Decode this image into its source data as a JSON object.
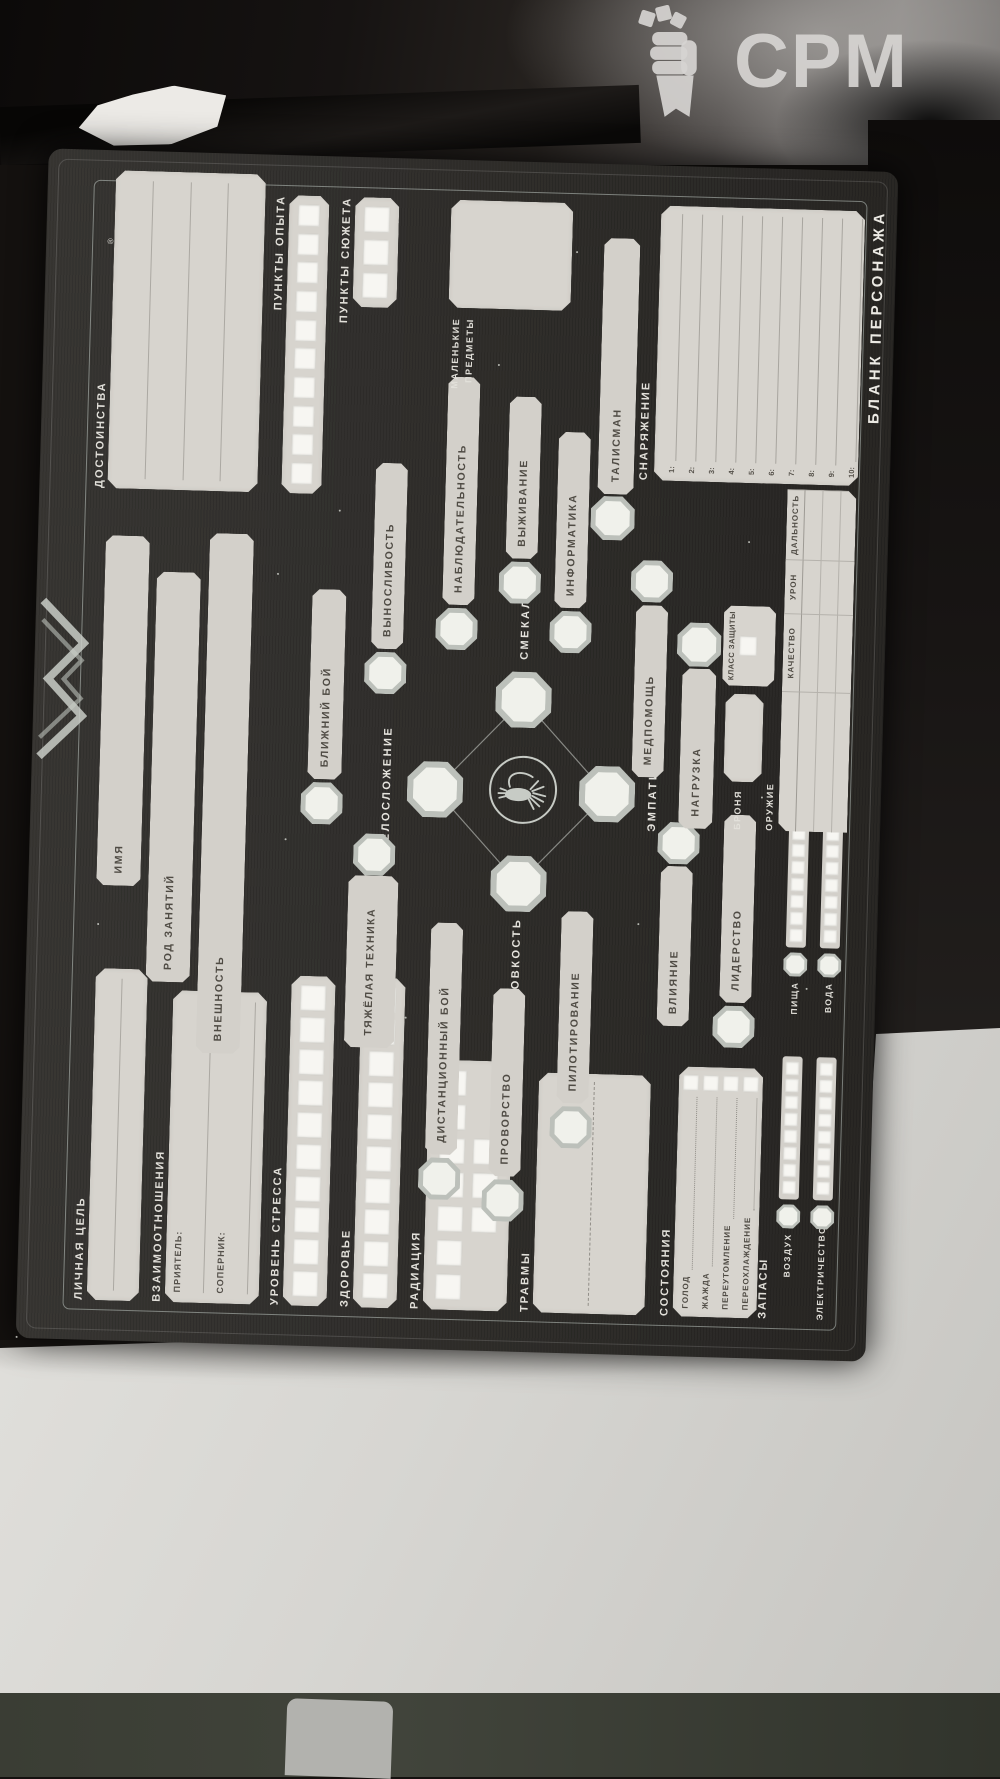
{
  "watermark": {
    "brand": "CPM"
  },
  "sheet": {
    "title": "БЛАНК ПЕРСОНАЖА",
    "reg_mark": "®",
    "identity": {
      "name_label": "ИМЯ",
      "career_label": "РОД ЗАНЯТИЙ",
      "appearance_label": "ВНЕШНОСТЬ"
    },
    "left": {
      "personal_goal": "ЛИЧНАЯ ЦЕЛЬ",
      "relationships": "ВЗАИМООТНОШЕНИЯ",
      "buddy": "ПРИЯТЕЛЬ:",
      "rival": "СОПЕРНИК:",
      "stress": "УРОВЕНЬ СТРЕССА",
      "health": "ЗДОРОВЬЕ",
      "radiation": "РАДИАЦИЯ",
      "injuries": "ТРАВМЫ",
      "conditions": {
        "title": "СОСТОЯНИЯ",
        "items": [
          "ГОЛОД",
          "ЖАЖДА",
          "ПЕРЕУТОМЛЕНИЕ",
          "ПЕРЕОХЛАЖДЕНИЕ"
        ]
      },
      "supplies": {
        "title": "ЗАПАСЫ",
        "items": [
          "ВОЗДУХ",
          "ПИЩА",
          "ЭЛЕКТРИЧЕСТВО",
          "ВОДА"
        ]
      }
    },
    "attributes": [
      "ТЕЛОСЛОЖЕНИЕ",
      "ЛОВКОСТЬ",
      "СМЕКАЛКА",
      "ЭМПАТИЯ"
    ],
    "skills": {
      "strength": [
        "БЛИЖНИЙ БОЙ",
        "ТЯЖЁЛАЯ ТЕХНИКА",
        "ВЫНОСЛИВОСТЬ"
      ],
      "agility": [
        "ДИСТАНЦИОННЫЙ БОЙ",
        "ПРОВОРСТВО",
        "ПИЛОТИРОВАНИЕ"
      ],
      "wits": [
        "НАБЛЮДАТЕЛЬНОСТЬ",
        "ВЫЖИВАНИЕ",
        "ИНФОРМАТИКА"
      ],
      "empathy": [
        "МЕДПОМОЩЬ",
        "ВЛИЯНИЕ",
        "ЛИДЕРСТВО"
      ]
    },
    "right": {
      "talents": "ДОСТОИНСТВА",
      "xp": "ПУНКТЫ ОПЫТА",
      "story": "ПУНКТЫ СЮЖЕТА",
      "tiny_items": "МАЛЕНЬКИЕ ПРЕДМЕТЫ",
      "talisman": "ТАЛИСМАН",
      "gear": "СНАРЯЖЕНИЕ",
      "gear_numbers": [
        "1:",
        "2:",
        "3:",
        "4:",
        "5:",
        "6:",
        "7:",
        "8:",
        "9:",
        "10:"
      ]
    },
    "combat": {
      "encumbrance": "НАГРУЗКА",
      "armor": "БРОНЯ",
      "armor_rating": "КЛАСС ЗАЩИТЫ",
      "weapons": "ОРУЖИЕ",
      "quality": "КАЧЕСТВО",
      "damage": "УРОН",
      "range": "ДАЛЬНОСТЬ"
    },
    "counts": {
      "stress": 10,
      "health": 10,
      "radiation": 10,
      "xp": 10,
      "story": 3,
      "supply": 8
    }
  },
  "colors": {
    "mat": "#2e2c29",
    "panel": "#d7d4ce",
    "label": "#e2e0da",
    "accent_line": "#ced8d2"
  }
}
